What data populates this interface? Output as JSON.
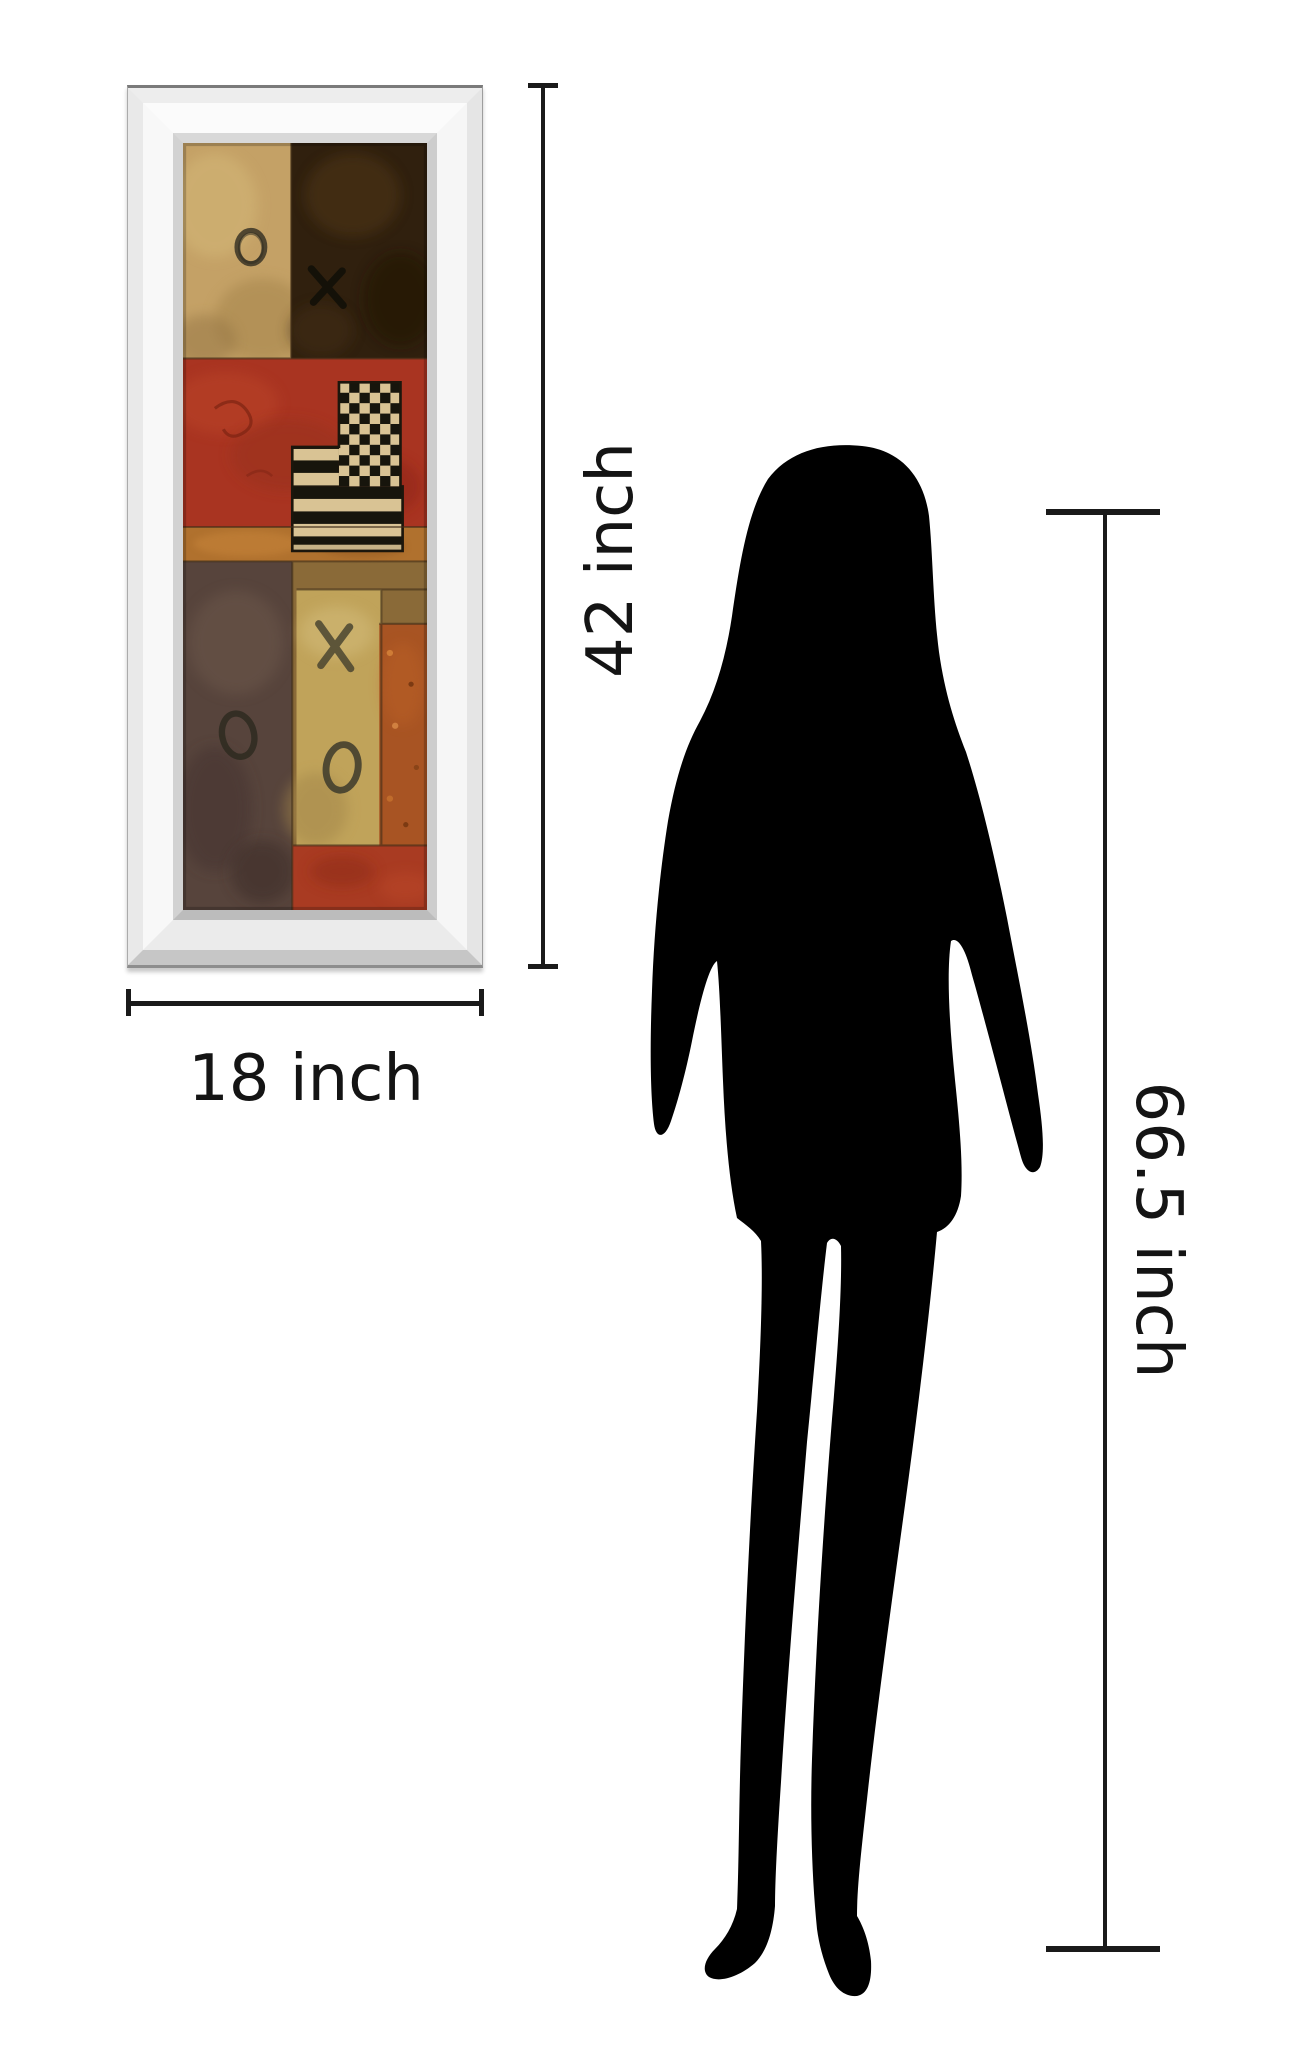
{
  "illustration": {
    "background_color": "#ffffff",
    "subject": "Framed wall art size comparison with standing woman silhouette"
  },
  "labels": {
    "frame_height": "42 inch",
    "frame_width": "18 inch",
    "person_height": "66.5 inch"
  },
  "dimension_style": {
    "line_color": "#1a1a1a"
  },
  "frame": {
    "style": "beveled mirror frame",
    "face_color": "#f7f7f7",
    "bevel_color": "#cdcdcd"
  },
  "artwork": {
    "description": "Abstract XO collage painting with checkered flag motif",
    "marks": [
      "O",
      "X",
      "O",
      "X",
      "O"
    ],
    "palette": {
      "tan": "#c4a166",
      "dark_brown": "#30200e",
      "red": "#a93421",
      "ochre": "#b0712e",
      "brown_gray": "#57443c",
      "yellow": "#c0a35a",
      "orange": "#a85423",
      "checker_cream": "#d9c394",
      "checker_black": "#17150c"
    }
  },
  "silhouette": {
    "subject": "standing woman",
    "color": "#000000"
  }
}
